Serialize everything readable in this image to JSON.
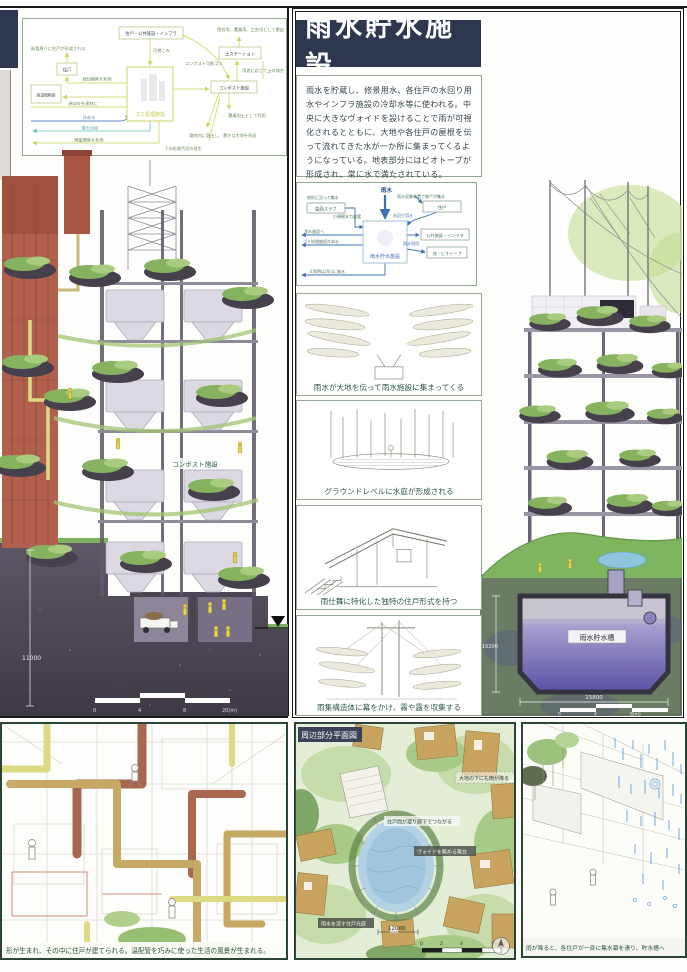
{
  "header": {
    "title": "雨水貯水施設",
    "description": "雨水を貯蔵し、修景用水、各住戸の水回り用水やインフラ施設の冷却水等に使われる。中央に大きなヴォイドを設けることで雨が可視化されるとともに、大地や各住戸の屋根を伝って流れてきた水が一か所に集まってくるようになっている。地表部分にはビオトープが形成され、常に水で満たされている。"
  },
  "colors": {
    "accent_navy": "#2e3750",
    "diagram_yellow_green": "#d5dd7e",
    "water_blue": "#3f6fae",
    "tank_purple": "#5b51a5"
  },
  "flow_diagram": {
    "nodes": {
      "housing_infra": "住戸・公共施設・インフラ",
      "house": "住戸",
      "greenhouse": "高温植物園",
      "waste": "ゴミ処理施設",
      "soil_station": "土ステーション",
      "compost": "コンポスト施設"
    },
    "labels": {
      "pipe_housing": "配管周りに住戸が形成される",
      "burnable": "可燃ごみ",
      "compostable": "コンポスト可能ゴミ",
      "shipping": "園芸用、農業用、工芸用として搬出",
      "soil_mix": "用途に応じて土の調合",
      "agri_soil": "農業用土として利用",
      "rich_land": "敷地内に客土し、豊かな大地を形成",
      "sludge": "下水処理汚泥の再生",
      "heat_use": "焼却廃熱を利用",
      "ash_material": "焼却灰を建材に",
      "cooling_water": "冷却水",
      "power_supply": "電力供給",
      "waste_heat": "廃棄廃熱を利用"
    }
  },
  "rain_diagram": {
    "nodes": {
      "rain": "雨水",
      "curved_slab": "曲面スラブ",
      "house": "住戸",
      "storage": "雨水貯水施設",
      "public_infra": "公共施設・インフラ",
      "pond_biotope": "池・ビオトープ"
    },
    "labels": {
      "collect_terrain": "地形に沿って集水",
      "micro_hydro": "小規模水力発電",
      "house_collect": "雨水収集装置で各戸が集水",
      "household_water": "水回り用水",
      "to_purification": "浄水施設へ",
      "waste_cooling": "ゴミ処理施設冷却水",
      "rain_use": "雨水利用",
      "flood_discharge": "大雨時は河川に放水"
    }
  },
  "sketch_captions": [
    "雨水が大地を伝って雨水施設に集まってくる",
    "グラウンドレベルに水庭が形成される",
    "雨仕舞に特化した独特の住戸形式を持つ",
    "雨集構造体に幕をかけ、霧や露を収集する"
  ],
  "left_drawing": {
    "compost_label": "コンポスト施設",
    "dim_height": "11000",
    "scale": {
      "t0": "0",
      "t1": "4",
      "t2": "8",
      "end": "20(m)"
    }
  },
  "right_drawing": {
    "tank_label": "雨水貯水槽",
    "dim_v": "16200",
    "dim_h": "15800",
    "scale": {
      "t0": "0",
      "t1": "4",
      "end": "8(m)"
    }
  },
  "site_plan": {
    "title": "周辺部分平面図",
    "labels": {
      "rain_below": "大地の下にも雨が降る",
      "corridor": "住戸間が渡り廊下でつながる",
      "stage": "ヴォイドを眺める舞台",
      "court": "雨水を流す住戸光庭",
      "dim": "12000"
    },
    "scale": {
      "t0": "0",
      "t1": "2",
      "t2": "4",
      "end": "6(m)"
    }
  },
  "captions": {
    "bottom_left": "形が生まれ、その中に住戸が建てられる。温配管を巧みに使った生活の風景が生まれる。",
    "bottom_right": "雨が降ると、各住戸が一斉に集水幕を張り、貯水槽へ"
  }
}
